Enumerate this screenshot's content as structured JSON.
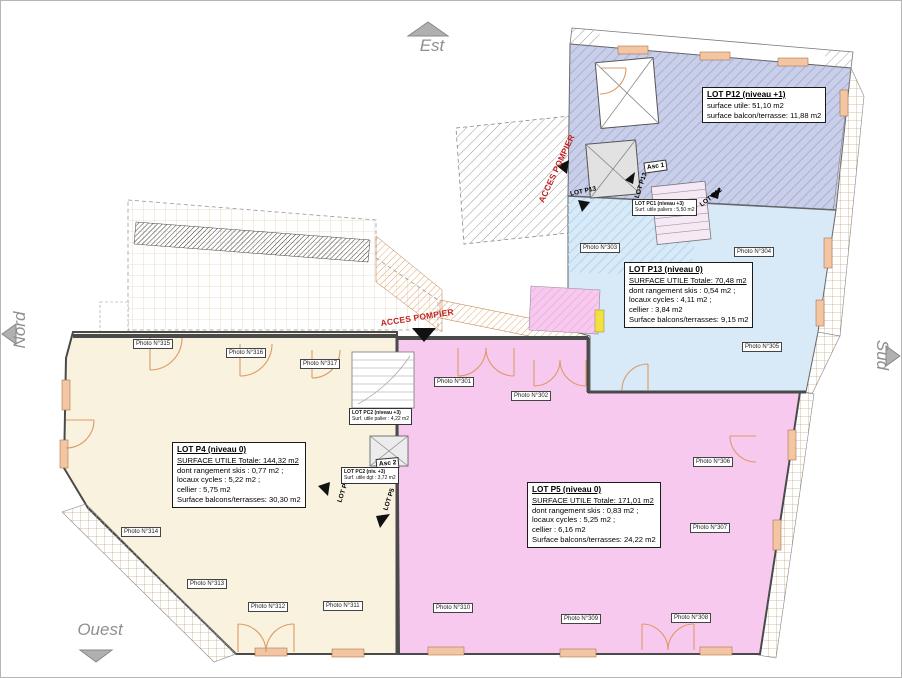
{
  "compass": {
    "est": "Est",
    "nord": "Nord",
    "sud": "Sud",
    "ouest": "Ouest"
  },
  "access": {
    "label_roof": "ACCES POMPIER",
    "label_side": "ACCES POMPIER"
  },
  "markers": {
    "p13_a": "LOT P13",
    "p13_b": "LOT P13",
    "p12": "LOT P12",
    "p4": "LOT P4",
    "p5": "LOT P5",
    "asc1": "Asc 1",
    "asc2": "Asc 2"
  },
  "lot_boxes": {
    "p12": {
      "title": "LOT P12 (niveau +1)",
      "line1": "surface utile: 51,10 m2",
      "line2": "surface balcon/terrasse: 11,88 m2"
    },
    "p13": {
      "title": "LOT P13 (niveau 0)",
      "total": "SURFACE UTILE Totale: 70,48 m2",
      "line1": "dont rangement skis : 0,54 m2 ;",
      "line2": "locaux cycles : 4,11 m2 ;",
      "line3": "cellier : 3,84 m2",
      "line4": "Surface balcons/terrasses: 9,15 m2"
    },
    "p4": {
      "title": "LOT P4 (niveau 0)",
      "total": "SURFACE UTILE Totale: 144,32 m2",
      "line1": "dont rangement skis : 0,77 m2 ;",
      "line2": "locaux cycles : 5,22 m2 ;",
      "line3": "cellier : 5,75 m2",
      "line4": "Surface balcons/terrasses: 30,30 m2"
    },
    "p5": {
      "title": "LOT P5 (niveau 0)",
      "total": "SURFACE UTILE Totale: 171,01 m2",
      "line1": "dont rangement skis : 0,83 m2 ;",
      "line2": "locaux cycles : 5,25 m2 ;",
      "line3": "cellier : 6,16 m2",
      "line4": "Surface balcons/terrasses: 24,22 m2"
    },
    "pc1": {
      "title": "LOT PC1 (niveau +3)",
      "line1": "Surf. utile paliers : 5,50 m2"
    },
    "pc2a": {
      "title": "LOT PC2 (niveau +3)",
      "line1": "Surf. utile palier : 4,22 m2"
    },
    "pc2b": {
      "title": "LOT PC2 (niv. +3)",
      "line1": "Surf. utile dgt : 3,72 m2"
    }
  },
  "photos": [
    "Photo N°315",
    "Photo N°316",
    "Photo N°317",
    "Photo N°301",
    "Photo N°302",
    "Photo N°303",
    "Photo N°304",
    "Photo N°305",
    "Photo N°306",
    "Photo N°307",
    "Photo N°308",
    "Photo N°309",
    "Photo N°310",
    "Photo N°311",
    "Photo N°312",
    "Photo N°313",
    "Photo N°314"
  ],
  "colors": {
    "lot_p4": "#f8f2df",
    "lot_p5": "#f7c9ef",
    "lot_p13": "#d8eaf8",
    "lot_p12": "#c9cfe8",
    "access_red": "#c32222",
    "door_arc": "#dd9a66",
    "wall": "#4a4a4a"
  }
}
